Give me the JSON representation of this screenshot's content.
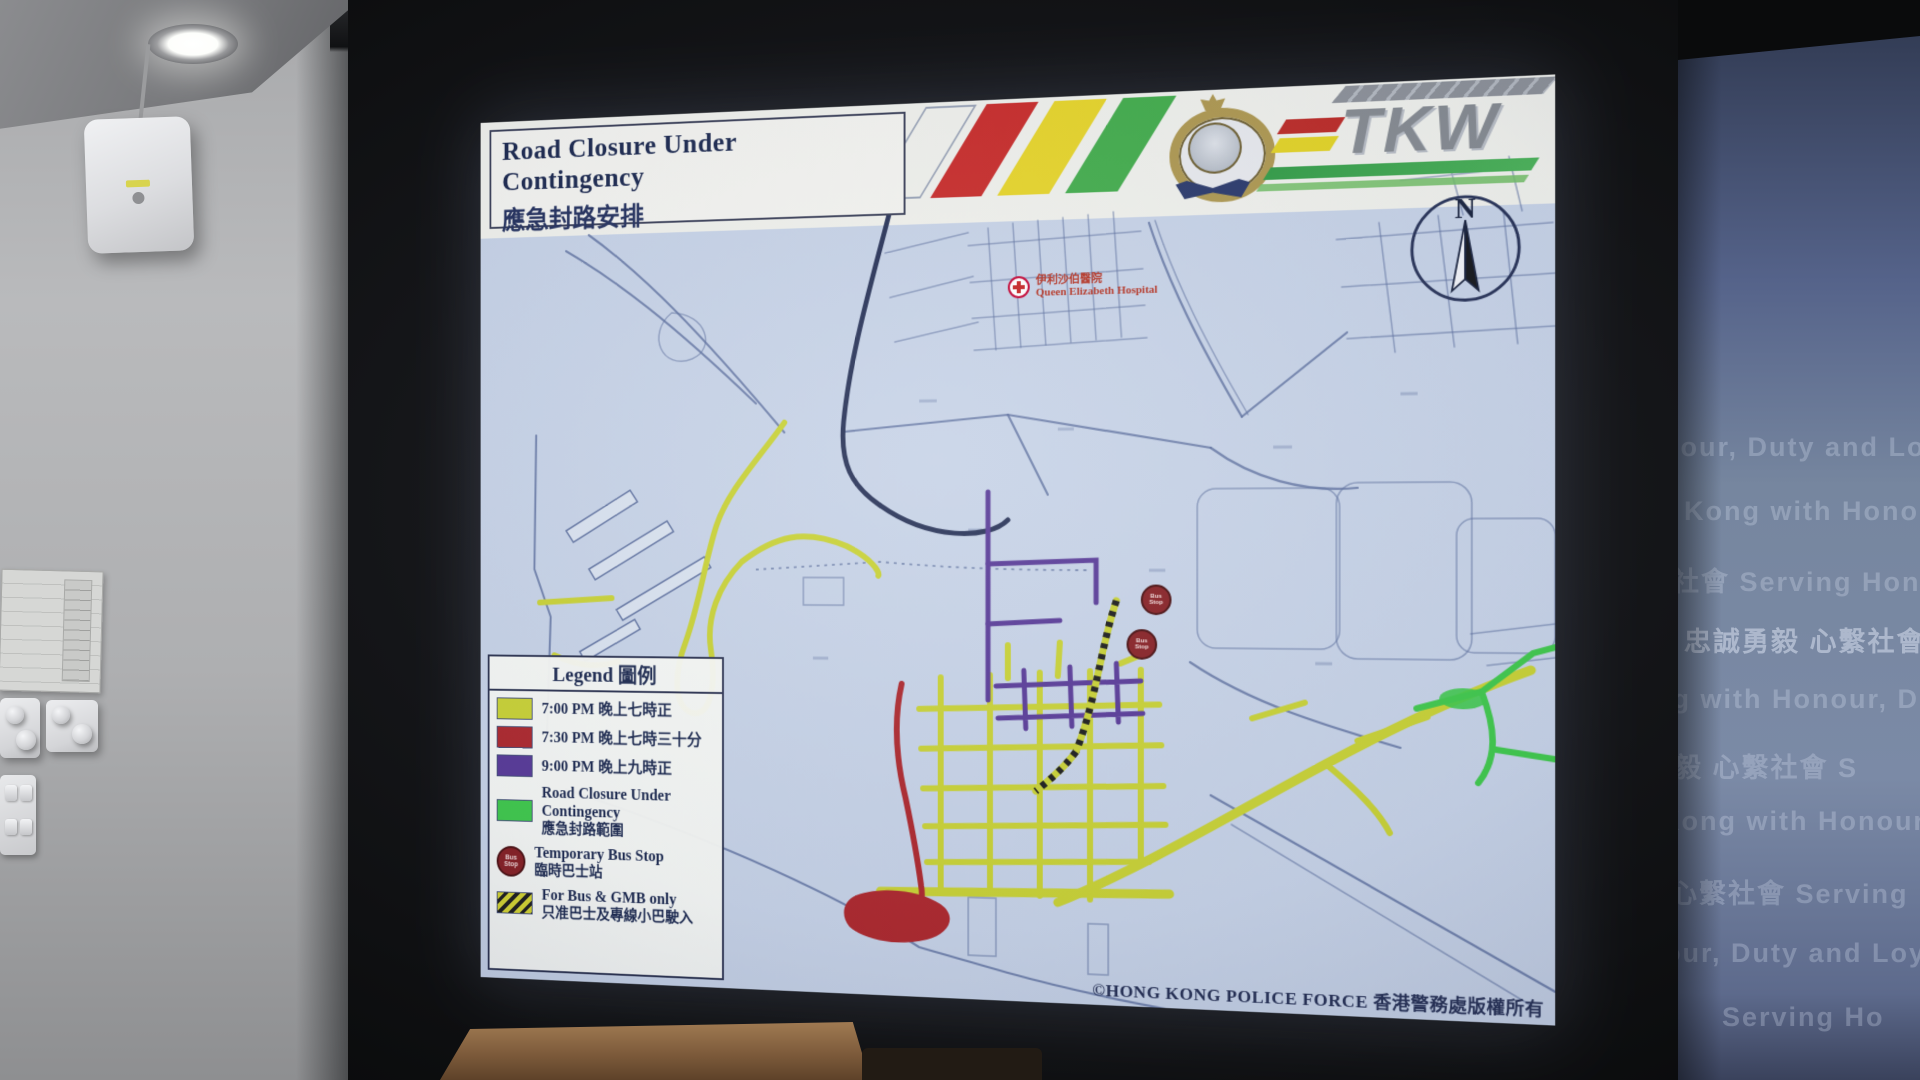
{
  "colors": {
    "yellow": "#c9d32e",
    "red": "#b3282d",
    "purple": "#5a3a9c",
    "green": "#3ccb49",
    "road": "#5b6fa0",
    "roadDark": "#27335a",
    "mapBg": "#c6d3e8",
    "headerBg": "#f0f1ec",
    "stripeRed": "#cf2a28",
    "stripeYellow": "#e8d521",
    "stripeGreen": "#3fae49",
    "busStop": "#8c2024",
    "panelBg": "#6e7fa4"
  },
  "screen": {
    "title_en": "Road Closure Under Contingency",
    "title_zh": "應急封路安排",
    "tkw_logo_text": "TKW",
    "compass_label": "N",
    "hospital": {
      "name_zh": "伊利沙伯醫院",
      "name_en": "Queen Elizabeth Hospital"
    },
    "bus_stop_marker_text": "Bus Stop",
    "legend": {
      "title": "Legend 圖例",
      "items": [
        {
          "type": "swatch",
          "color": "#c9d32e",
          "line1": "7:00 PM 晚上七時正"
        },
        {
          "type": "swatch",
          "color": "#b3282d",
          "line1": "7:30 PM 晚上七時三十分"
        },
        {
          "type": "swatch",
          "color": "#5a3a9c",
          "line1": "9:00 PM 晚上九時正"
        },
        {
          "type": "swatch",
          "color": "#3ccb49",
          "line1": "Road Closure Under Contingency",
          "line2": "應急封路範圍"
        },
        {
          "type": "bus-stop",
          "icon_text": "Bus Stop",
          "line1": "Temporary Bus Stop",
          "line2": "臨時巴士站"
        },
        {
          "type": "hatch",
          "line1": "For Bus & GMB only",
          "line2": "只准巴士及專線小巴駛入"
        }
      ]
    },
    "copyright": "©HONG KONG POLICE FORCE 香港警務處版權所有"
  },
  "wall_text": {
    "rows": [
      {
        "text": "nour, Duty  and Loyal",
        "x": -16,
        "y": 432,
        "bright": false
      },
      {
        "text": "g Kong with Honour, D",
        "x": -22,
        "y": 496,
        "bright": false
      },
      {
        "text": "社會      Serving Hong",
        "x": -6,
        "y": 560,
        "bright": false
      },
      {
        "text": "忠誠勇毅 心繫社會",
        "x": 6,
        "y": 620,
        "bright": true
      },
      {
        "text": "ng with Honour, D",
        "x": -24,
        "y": 684,
        "bright": false
      },
      {
        "text": "毅 心繫社會      S",
        "x": -4,
        "y": 746,
        "bright": false
      },
      {
        "text": "Kong with Honour, Dut",
        "x": -18,
        "y": 806,
        "bright": false
      },
      {
        "text": "心繫社會      Serving",
        "x": -8,
        "y": 872,
        "bright": false
      },
      {
        "text": "our, Duty and Loyal",
        "x": -14,
        "y": 938,
        "bright": false
      },
      {
        "text": "Serving Ho",
        "x": 44,
        "y": 1002,
        "bright": false
      }
    ]
  }
}
